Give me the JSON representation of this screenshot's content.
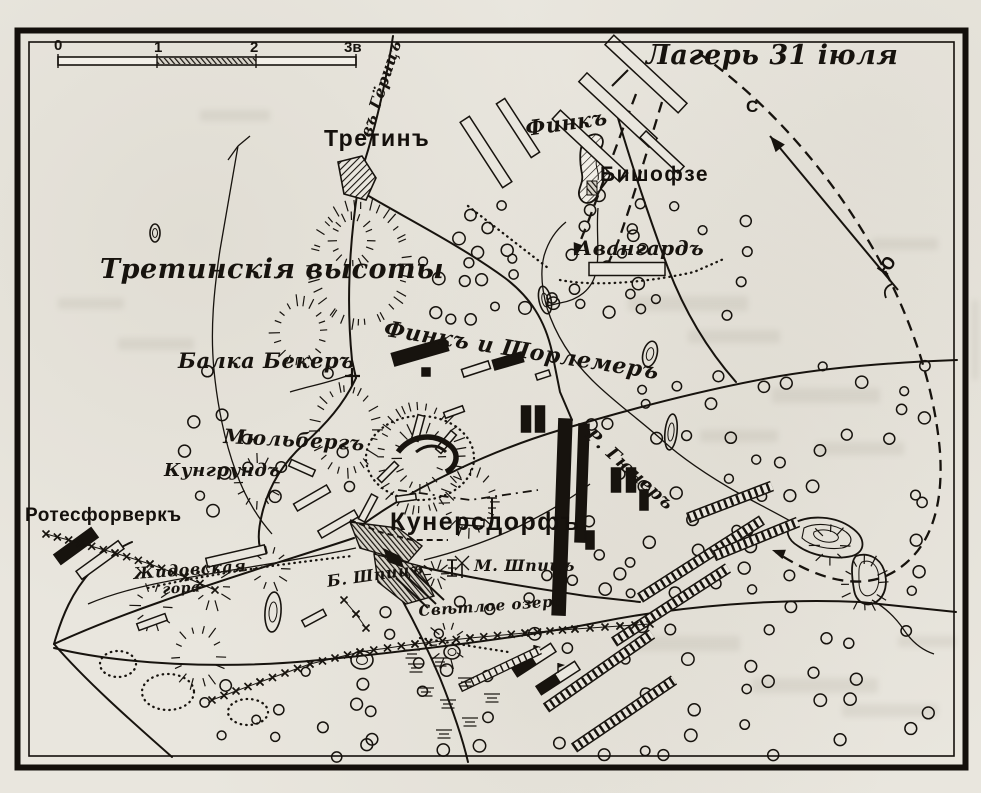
{
  "map": {
    "scale_bar": {
      "ticks": [
        "0",
        "1",
        "2",
        "3в"
      ]
    },
    "compass": {
      "north": "С",
      "south": "Ю"
    },
    "labels": {
      "camp": "Лагерь 31 іюля",
      "road_goeritz": "въ Гёрицъ",
      "tretin": "Третинъ",
      "finck": "Финкъ",
      "bischofsee": "Бишофзе",
      "avantgarde": "Авангардъ",
      "tretin_heights": "Третинскія высоты",
      "balka_beker": "Балка Бекеръ",
      "finck_schorlemer": "Финкъ и Шорлемеръ",
      "muehlberg": "Мюльбергъ",
      "kuhgrund": "Кунгрундъ",
      "kunersdorf": "Кунерсдорфъ",
      "river_huener": "Р. Гюнеръ",
      "rotes_vorwerk": "Ротесфорверкъ",
      "zhidovskaya_gora_1": "Жидовская",
      "zhidovskaya_gora_2": "гора",
      "b_spitz": "Б. Шпицъ",
      "m_spitz": "М. Шпицъ",
      "svetloe_ozero": "Свѣтлое озеро"
    }
  }
}
